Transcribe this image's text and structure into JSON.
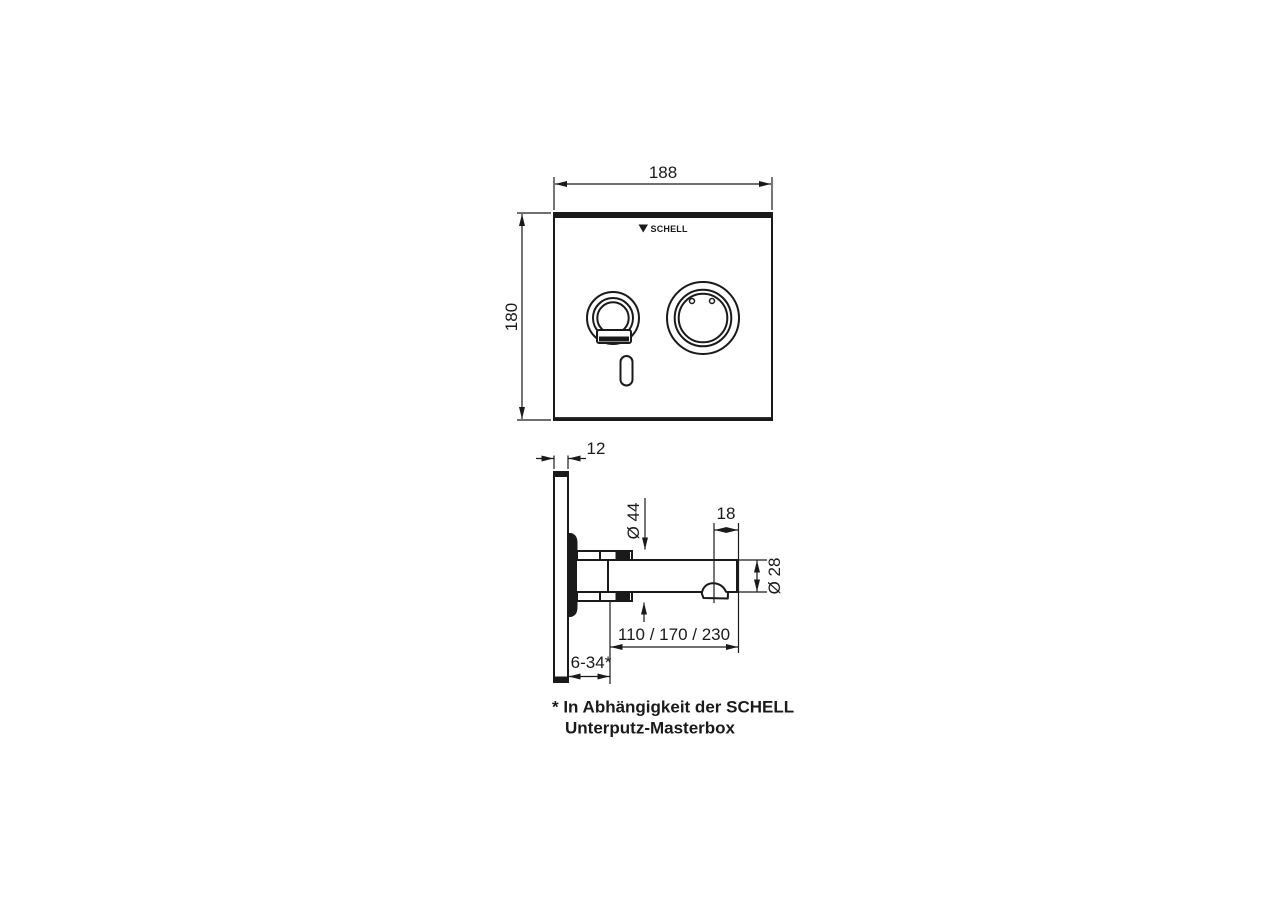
{
  "meta": {
    "background_color": "#ffffff",
    "line_color": "#1a1a1a"
  },
  "front_view": {
    "width": "188",
    "height": "180",
    "brand": "SCHELL"
  },
  "side_view": {
    "panel_thickness": "12",
    "flange_diameter": "Ø 44",
    "outlet_to_tip": "18",
    "spout_diameter": "Ø 28",
    "spout_projection": "110 / 170 / 230",
    "recess_depth": "6-34*"
  },
  "footnote": {
    "line1": "* In Abhängigkeit der SCHELL",
    "line2": "Unterputz-Masterbox"
  }
}
